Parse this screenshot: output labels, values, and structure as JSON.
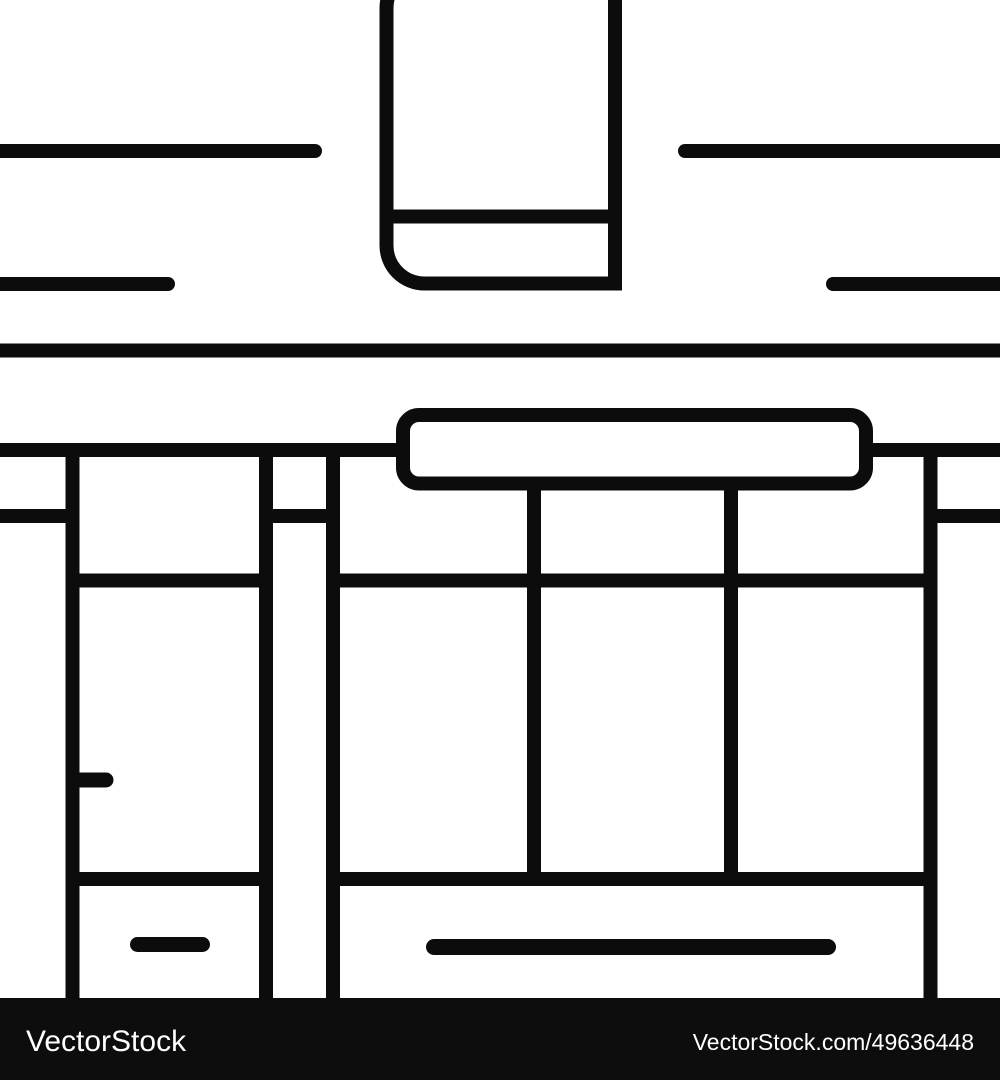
{
  "artwork": {
    "icon_name": "shop-storefront-line-icon",
    "ink_color": "#0c0c0c",
    "background_color": "#ffffff"
  },
  "watermark": {
    "bar_color": "#0d0d0d",
    "text_color": "#ffffff",
    "left_text": "VectorStock",
    "right_text": "VectorStock.com/49636448"
  }
}
